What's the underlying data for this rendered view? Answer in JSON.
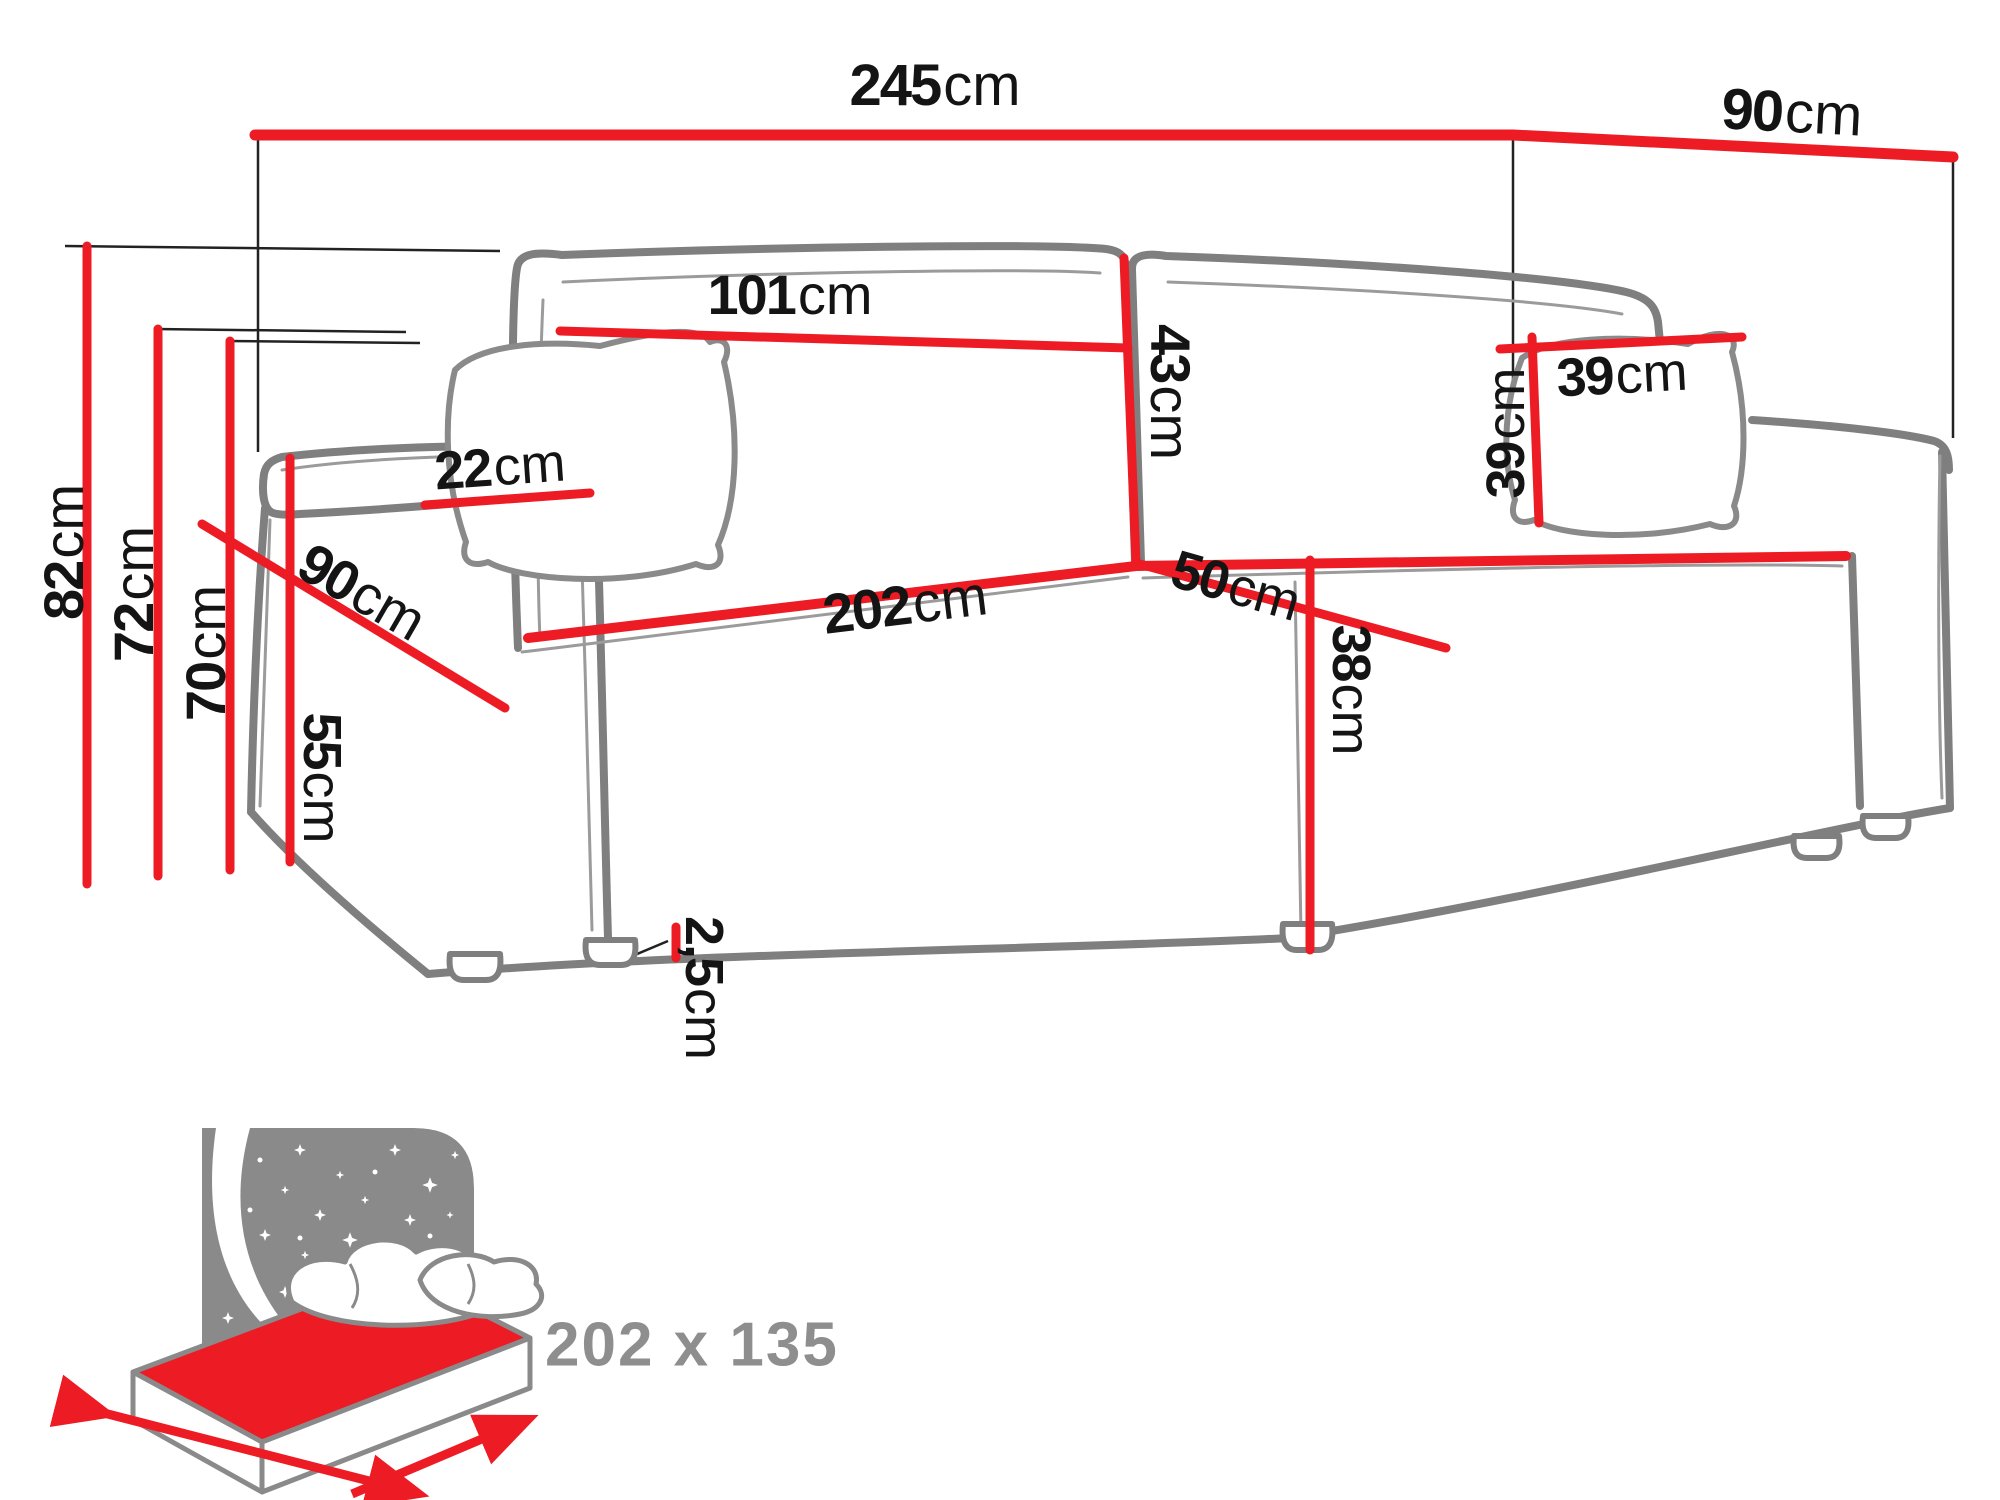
{
  "diagram": {
    "type": "sofa-dimension-diagram",
    "accent_color": "#ed1c24",
    "outline_color": "#7f7f7f",
    "text_color": "#141414",
    "muted_text_color": "#8e8e8e",
    "dimensions": [
      {
        "id": "total-width",
        "value": "245",
        "unit": "cm",
        "rotation": 0,
        "x": 935,
        "y": 86,
        "size": 58
      },
      {
        "id": "total-depth",
        "value": "90",
        "unit": "cm",
        "rotation": 3,
        "x": 1792,
        "y": 113,
        "size": 58
      },
      {
        "id": "backrest-cushion-width",
        "value": "101",
        "unit": "cm",
        "rotation": 0,
        "x": 790,
        "y": 295,
        "size": 56
      },
      {
        "id": "backrest-cushion-height",
        "value": "43",
        "unit": "cm",
        "rotation": 90,
        "x": 1170,
        "y": 392,
        "size": 56
      },
      {
        "id": "pillow-width",
        "value": "39",
        "unit": "cm",
        "rotation": -3,
        "x": 1622,
        "y": 375,
        "size": 54
      },
      {
        "id": "pillow-height",
        "value": "39",
        "unit": "cm",
        "rotation": -90,
        "x": 1506,
        "y": 433,
        "size": 54
      },
      {
        "id": "armrest-width",
        "value": "22",
        "unit": "cm",
        "rotation": -4,
        "x": 500,
        "y": 467,
        "size": 54
      },
      {
        "id": "armrest-depth",
        "value": "90",
        "unit": "cm",
        "rotation": 30,
        "x": 362,
        "y": 592,
        "size": 56
      },
      {
        "id": "seat-depth",
        "value": "50",
        "unit": "cm",
        "rotation": 16,
        "x": 1236,
        "y": 586,
        "size": 54
      },
      {
        "id": "seat-width",
        "value": "202",
        "unit": "cm",
        "rotation": -7,
        "x": 905,
        "y": 605,
        "size": 56
      },
      {
        "id": "total-height",
        "value": "82",
        "unit": "cm",
        "rotation": -90,
        "x": 64,
        "y": 552,
        "size": 56
      },
      {
        "id": "backrest-height",
        "value": "72",
        "unit": "cm",
        "rotation": -90,
        "x": 134,
        "y": 594,
        "size": 56
      },
      {
        "id": "back-height",
        "value": "70",
        "unit": "cm",
        "rotation": -90,
        "x": 206,
        "y": 653,
        "size": 56
      },
      {
        "id": "armrest-height",
        "value": "55",
        "unit": "cm",
        "rotation": 90,
        "x": 322,
        "y": 778,
        "size": 54
      },
      {
        "id": "seat-height",
        "value": "38",
        "unit": "cm",
        "rotation": 90,
        "x": 1351,
        "y": 690,
        "size": 54
      },
      {
        "id": "leg-height",
        "value": "2,5",
        "unit": "cm",
        "rotation": 90,
        "x": 704,
        "y": 988,
        "size": 54
      }
    ],
    "sleeping_area": {
      "label": "202 x 135"
    }
  }
}
